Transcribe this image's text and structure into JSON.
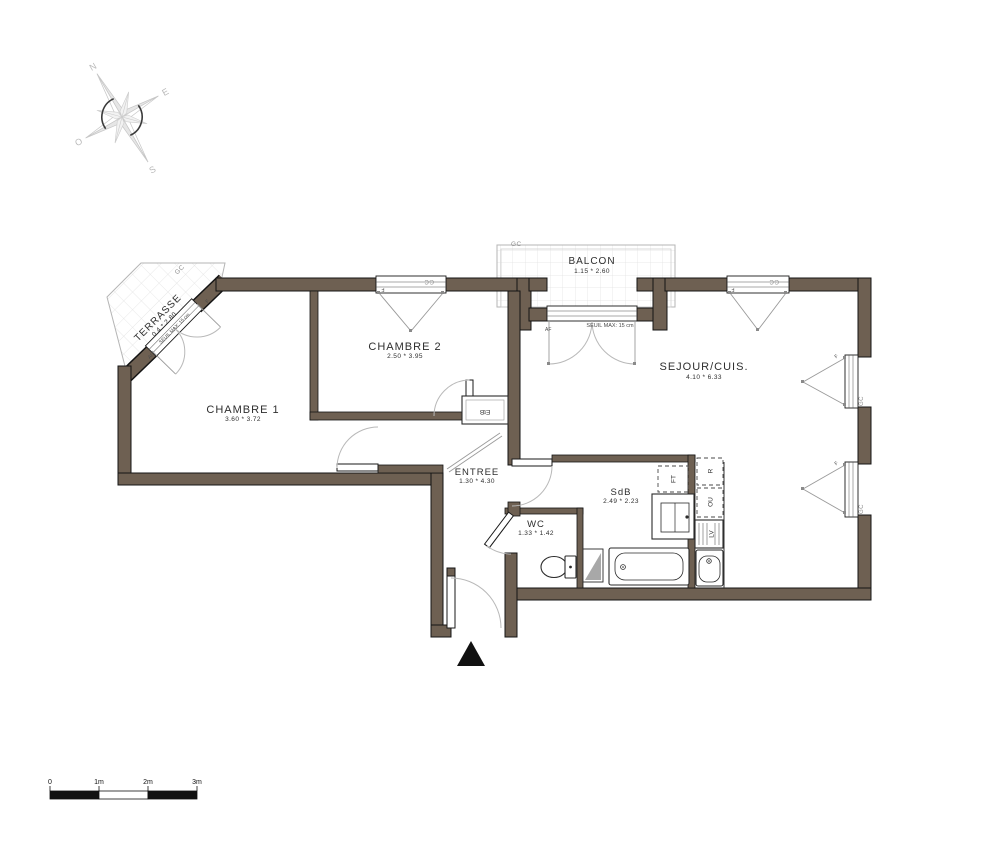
{
  "plan": {
    "compass": {
      "n": "N",
      "e": "E",
      "s": "S",
      "o": "O"
    },
    "rooms": [
      {
        "id": "terrasse",
        "name": "TERRASSE",
        "dims": "0.4 * 2.80"
      },
      {
        "id": "balcon",
        "name": "BALCON",
        "dims": "1.15 * 2.60"
      },
      {
        "id": "chambre1",
        "name": "CHAMBRE 1",
        "dims": "3.60 * 3.72"
      },
      {
        "id": "chambre2",
        "name": "CHAMBRE 2",
        "dims": "2.50 * 3.95"
      },
      {
        "id": "sejour",
        "name": "SEJOUR/CUIS.",
        "dims": "4.10 * 6.33"
      },
      {
        "id": "entree",
        "name": "ENTREE",
        "dims": "1.30 * 4.30"
      },
      {
        "id": "wc",
        "name": "WC",
        "dims": "1.33 * 1.42"
      },
      {
        "id": "sdb",
        "name": "SdB",
        "dims": "2.49 * 2.23"
      }
    ],
    "appliances": {
      "ft": "FT",
      "r": "R",
      "ou": "OU",
      "lv": "LV",
      "etb": "EtB"
    },
    "annotations": {
      "gc": "GC",
      "f": "F",
      "af": "AF",
      "af2": "Af",
      "seuil": "SEUIL MAX: 15 cm"
    },
    "scale": {
      "t0": "0",
      "t1": "1m",
      "t2": "2m",
      "t3": "3m"
    },
    "colors": {
      "wall": "#6e6052",
      "outline": "#141414",
      "light": "#b5b5b5",
      "grid": "#e0e0e0",
      "label": "#2e2e2e",
      "graylabel": "#8f8f8f"
    }
  }
}
